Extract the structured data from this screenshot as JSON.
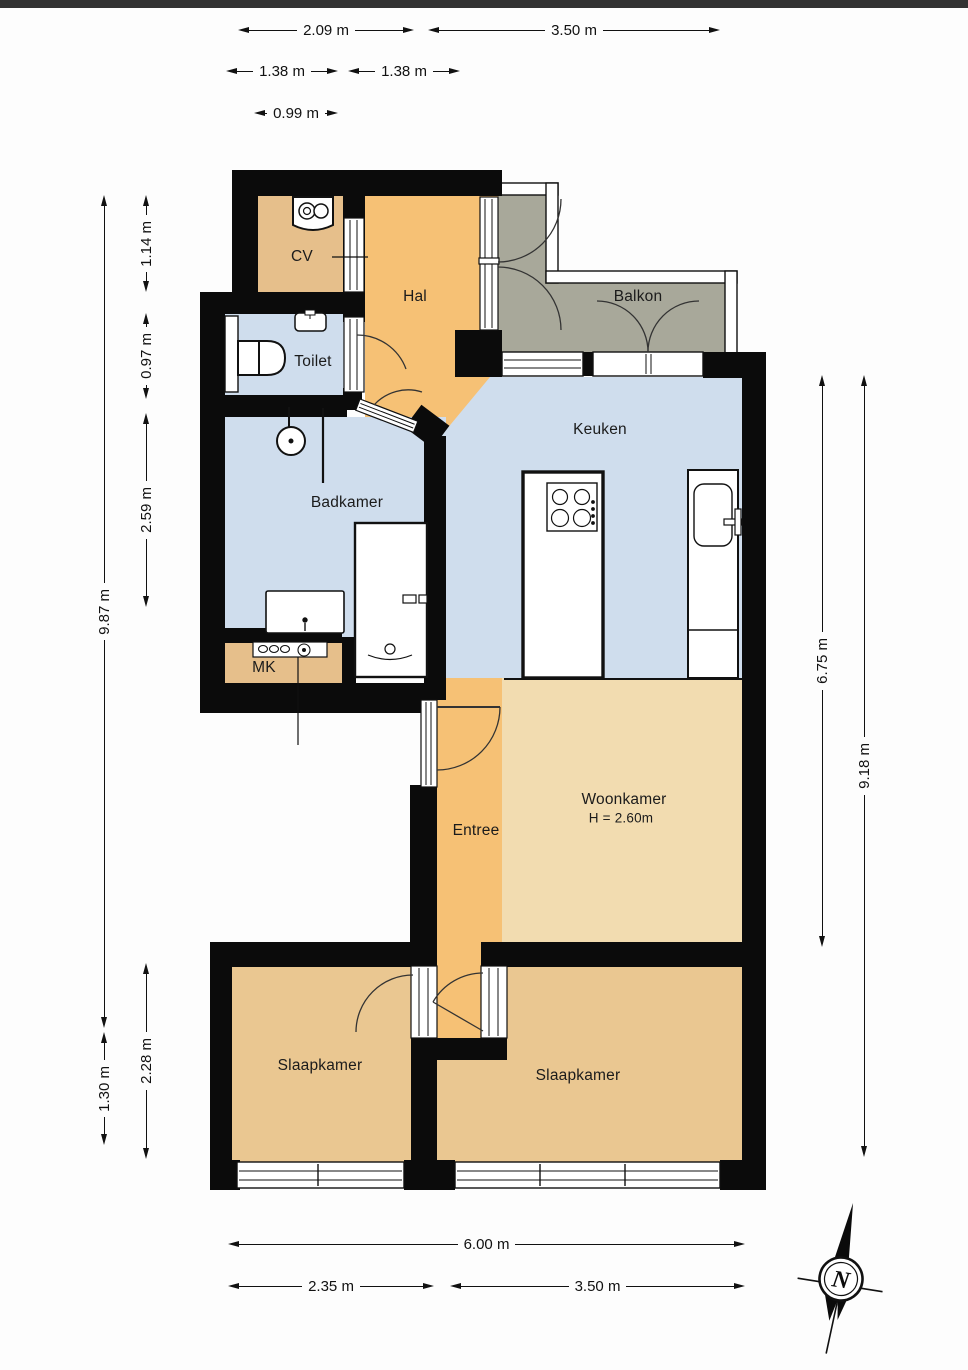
{
  "floorplan": {
    "rooms": [
      {
        "id": "cv",
        "label": "CV"
      },
      {
        "id": "hal",
        "label": "Hal"
      },
      {
        "id": "balkon",
        "label": "Balkon"
      },
      {
        "id": "toilet",
        "label": "Toilet"
      },
      {
        "id": "keuken",
        "label": "Keuken"
      },
      {
        "id": "badkamer",
        "label": "Badkamer"
      },
      {
        "id": "mk",
        "label": "MK"
      },
      {
        "id": "entree",
        "label": "Entree"
      },
      {
        "id": "woonkamer",
        "label": "Woonkamer",
        "height_label": "H = 2.60m"
      },
      {
        "id": "slaapkamer-left",
        "label": "Slaapkamer"
      },
      {
        "id": "slaapkamer-right",
        "label": "Slaapkamer"
      }
    ],
    "compass": {
      "north_label": "N"
    },
    "colors": {
      "wall": "#0b0b0b",
      "hal": "#f6c175",
      "cv": "#e6bf8b",
      "wet": "#cfdded",
      "balkon": "#a8a89a",
      "woonkamer": "#f2dcb0",
      "bedroom": "#eac791",
      "topbar": "#333333",
      "line": "#111111"
    }
  },
  "dimensions": {
    "top": [
      {
        "label": "2.09 m"
      },
      {
        "label": "3.50 m"
      },
      {
        "label": "1.38 m"
      },
      {
        "label": "1.38 m"
      },
      {
        "label": "0.99 m"
      }
    ],
    "left": [
      {
        "label": "9.87 m"
      },
      {
        "label": "1.14 m"
      },
      {
        "label": "0.97 m"
      },
      {
        "label": "2.59 m"
      },
      {
        "label": "2.28 m"
      },
      {
        "label": "1.30 m"
      }
    ],
    "right": [
      {
        "label": "6.75 m"
      },
      {
        "label": "9.18 m"
      }
    ],
    "bottom": [
      {
        "label": "6.00 m"
      },
      {
        "label": "2.35 m"
      },
      {
        "label": "3.50 m"
      }
    ]
  }
}
